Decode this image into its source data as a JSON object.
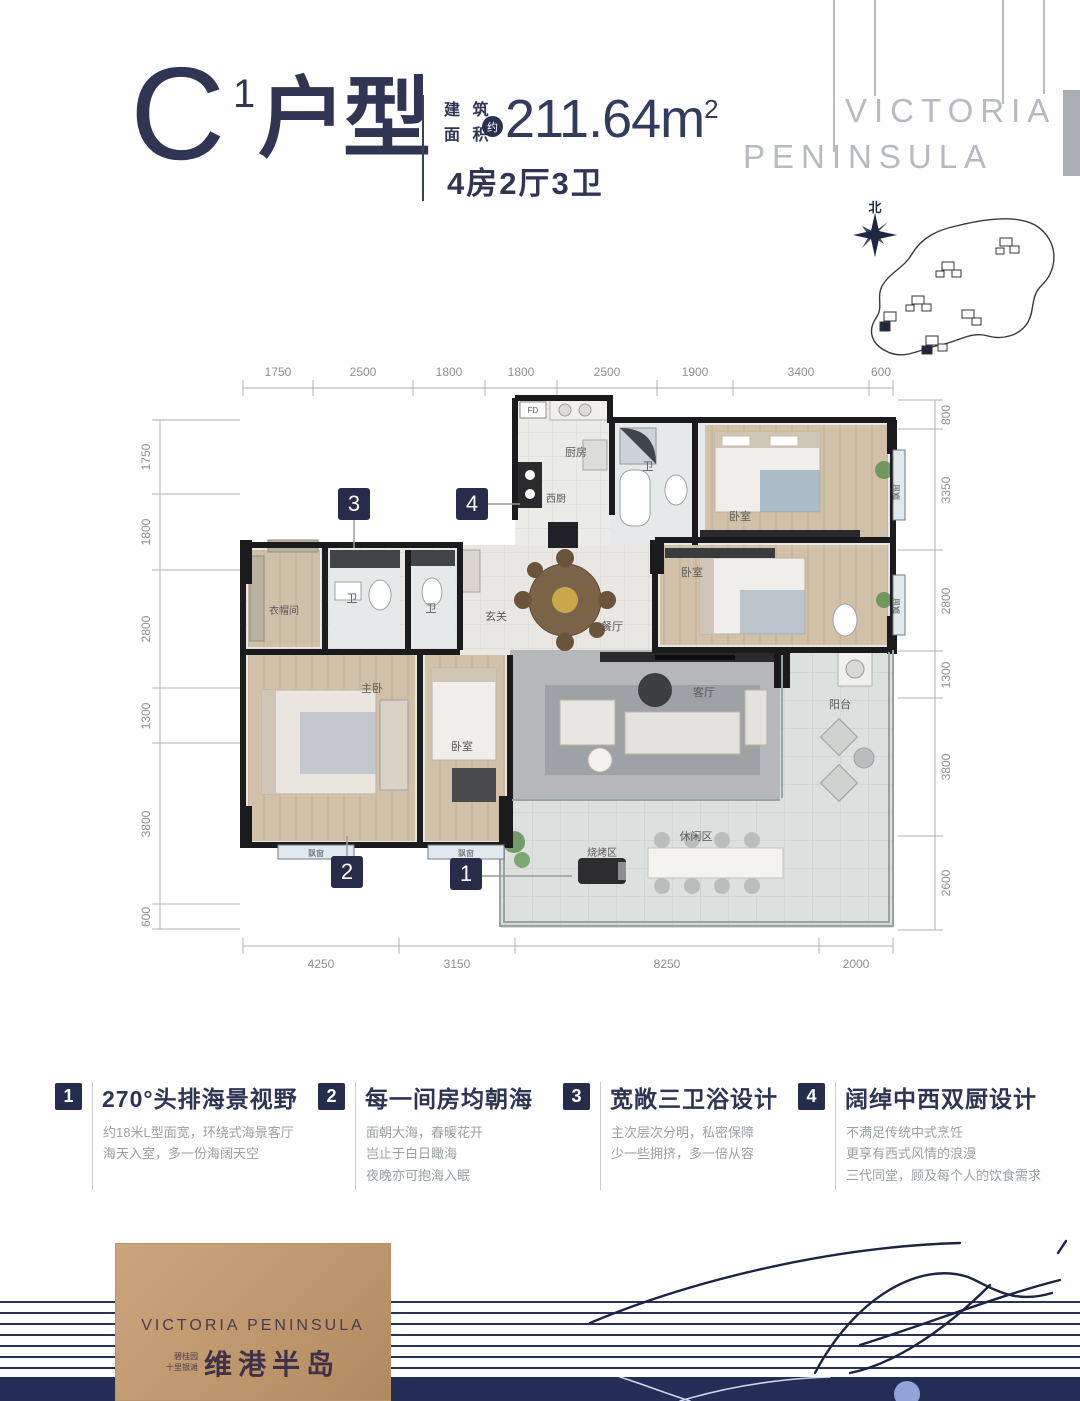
{
  "header": {
    "unit_letter": "C",
    "unit_sup": "1",
    "unit_suffix": "户型",
    "area_label": "建 筑\n面 积",
    "area_approx": "约",
    "area_value": "211.64m",
    "area_sup": "2",
    "layout": "4房2厅3卫"
  },
  "watermark": {
    "line1": "VICTORIA",
    "line2": "PENINSULA"
  },
  "sitemap": {
    "north_label": "北"
  },
  "floorplan": {
    "dims_top": [
      "1750",
      "2500",
      "1800",
      "1800",
      "2500",
      "1900",
      "3400",
      "600"
    ],
    "dims_left": [
      "1750",
      "1800",
      "2800",
      "1300",
      "3800",
      "600"
    ],
    "dims_right": [
      "800",
      "3350",
      "2800",
      "1300",
      "3800",
      "2600"
    ],
    "dims_bottom": [
      "4250",
      "3150",
      "8250",
      "2000"
    ],
    "rooms": {
      "fd": "FD",
      "kitchen": "厨房",
      "west_kitchen": "西厨",
      "bath": "卫",
      "bedroom": "卧室",
      "foyer": "玄关",
      "cloak": "衣帽间",
      "master": "主卧",
      "dining": "餐厅",
      "living": "客厅",
      "balcony": "阳台",
      "leisure": "休闲区",
      "bbq": "烧烤区",
      "bay": "飘窗"
    },
    "markers": {
      "m1": "1",
      "m2": "2",
      "m3": "3",
      "m4": "4"
    }
  },
  "features": [
    {
      "num": "1",
      "title": "270°头排海景视野",
      "desc": [
        "约18米L型面宽，环绕式海景客厅",
        "海天入室，多一份海阔天空",
        ""
      ]
    },
    {
      "num": "2",
      "title": "每一间房均朝海",
      "desc": [
        "面朝大海，春暖花开",
        "岂止于白日瞰海",
        "夜晚亦可抱海入眠"
      ]
    },
    {
      "num": "3",
      "title": "宽敞三卫浴设计",
      "desc": [
        "主次层次分明，私密保障",
        "少一些拥挤，多一倍从容",
        ""
      ]
    },
    {
      "num": "4",
      "title": "阔绰中西双厨设计",
      "desc": [
        "不满足传统中式烹饪",
        "更享有西式风情的浪漫",
        "三代同堂，顾及每个人的饮食需求"
      ]
    }
  ],
  "logo": {
    "en": "VICTORIA PENINSULA",
    "small": "碧桂园\n十里银滩",
    "cn": "维港半岛"
  },
  "colors": {
    "navy": "#2e3454",
    "marker_navy": "#262c4a",
    "dim_gray": "#8f8f8f",
    "watermark_gray": "#b7bac1",
    "footer_navy": "#242d55",
    "logo_gold_light": "#cba57e",
    "logo_gold_dark": "#b08a5f",
    "wall_black": "#1b1b1d",
    "wood_floor": "#d2c1a9",
    "tile_floor": "#e8e7e4"
  }
}
